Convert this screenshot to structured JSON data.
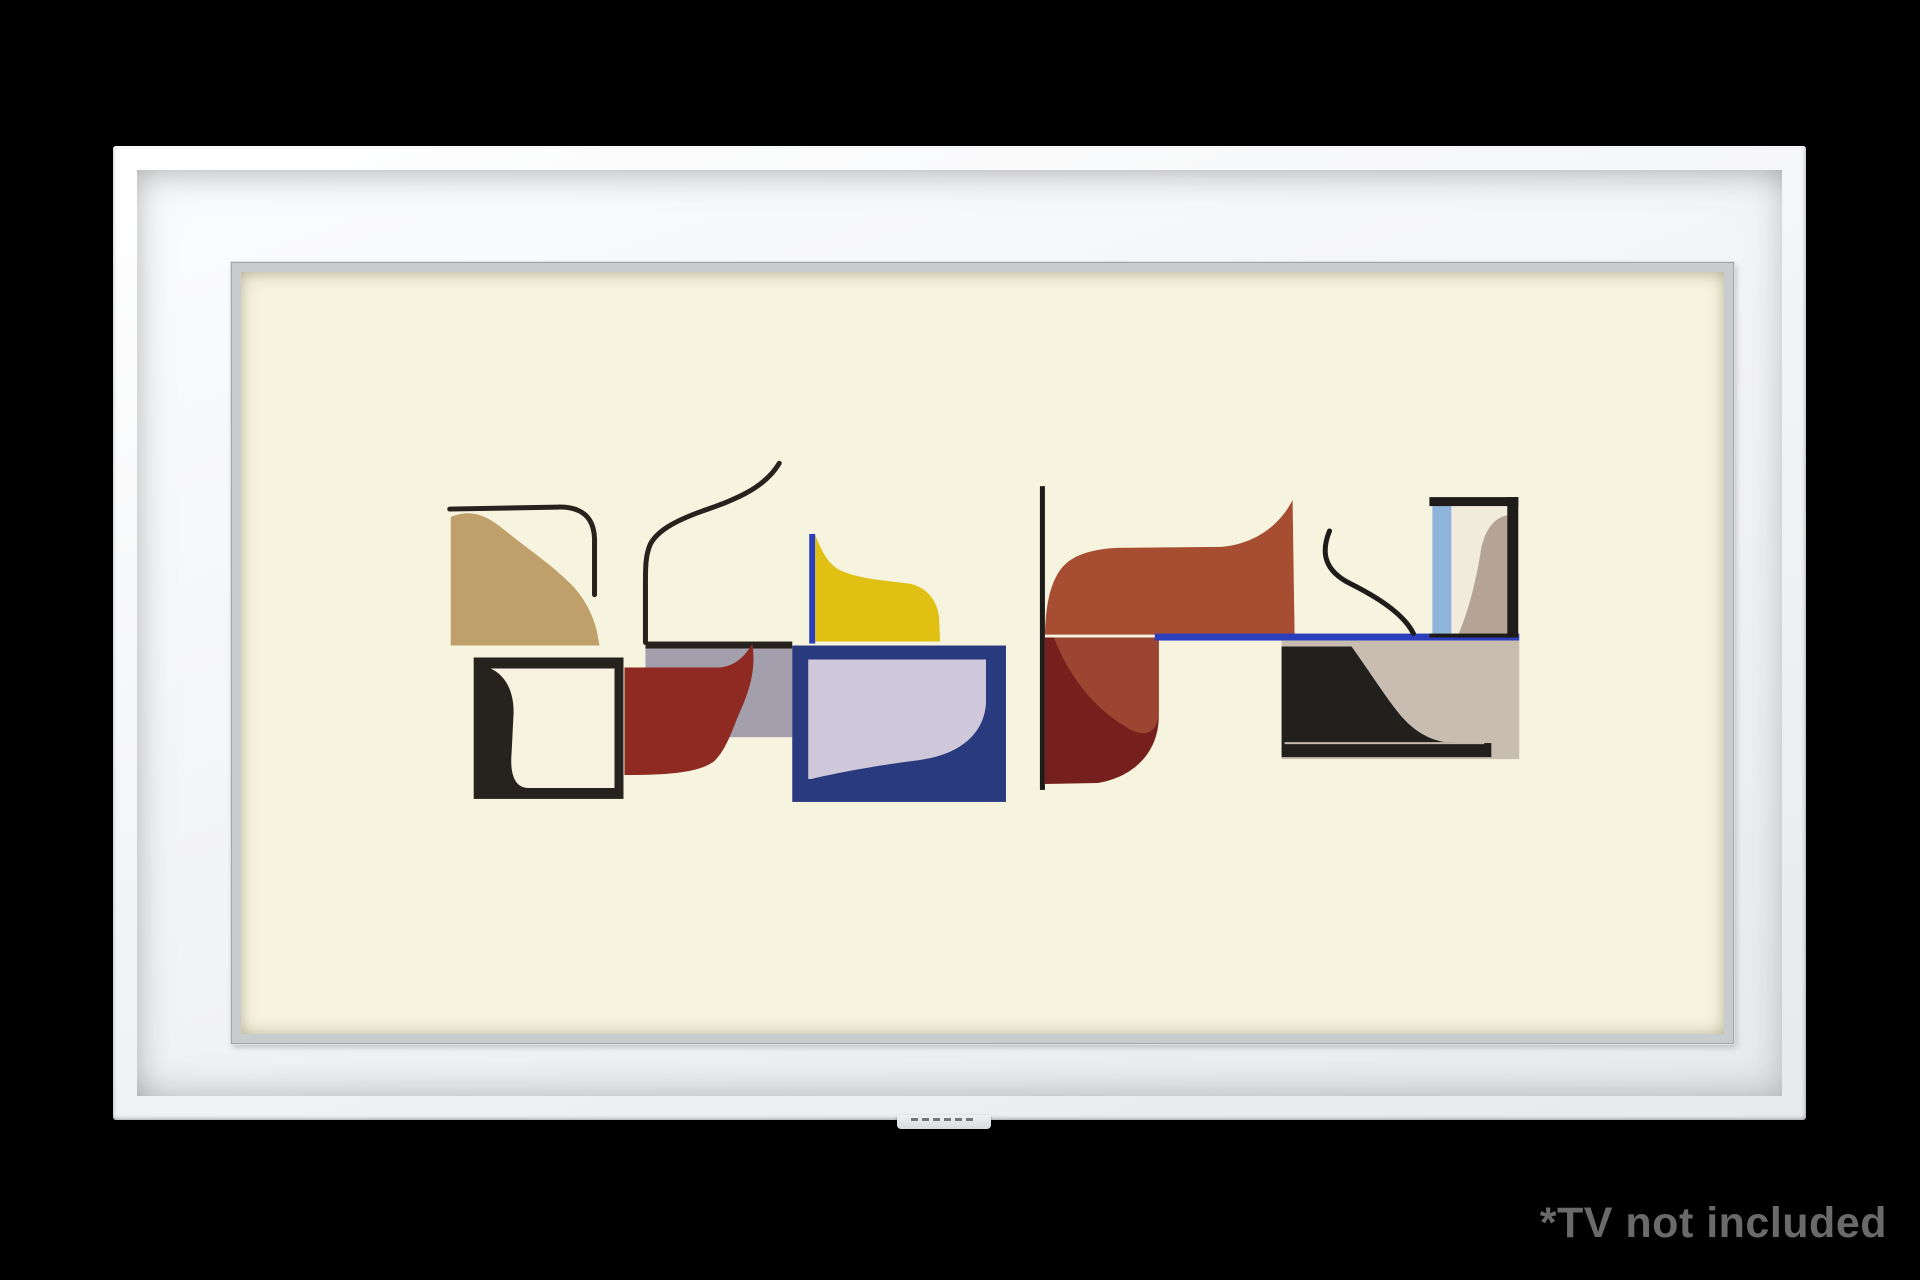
{
  "scene": {
    "background_color": "#000000",
    "description": "Samsung The Frame style white picture frame on black background"
  },
  "disclaimer": {
    "text": "*TV not included",
    "color": "#6a6a6a"
  },
  "frame": {
    "colors": {
      "molding": "#f7f8fa",
      "mat": "#f2f3f5",
      "bevel": "#c9ccce",
      "bottom_tab": "#e4e5e7"
    }
  },
  "artwork": {
    "title": "abstract mid-century composition",
    "canvas_color": "#f6f3de",
    "viewbox": "218 248 1485 765",
    "shapes": [
      {
        "name": "gray-strip",
        "kind": "rect",
        "x": 623,
        "y": 626,
        "w": 147,
        "h": 89,
        "fill": "#a49fad"
      },
      {
        "name": "gray-strip-top-line",
        "kind": "rect",
        "x": 623,
        "y": 619,
        "w": 147,
        "h": 7,
        "fill": "#26231f"
      },
      {
        "name": "red-wave-shape",
        "kind": "path",
        "d": "M602,645 L697,645 C712,644 723,634 730,621 C734,647 727,669 717,691 C709,710 704,727 692,739 C676,751 645,753 602,753 Z",
        "fill": "#8e2a22"
      },
      {
        "name": "tan-wave-square",
        "kind": "path",
        "d": "M428,623 L428,494 C446,486 462,491 478,504 C505,526 528,541 548,561 C562,575 570,592 574,607 L577,623 Z",
        "fill": "#bfa06b"
      },
      {
        "name": "tan-top-corner-line",
        "kind": "path",
        "d": "M427,486 L535,484 Q571,483 572,516 L572,572",
        "stroke": "#26231f",
        "sw": 5
      },
      {
        "name": "left-s-curve-line",
        "kind": "path",
        "d": "M757,440 C741,467 708,478 680,488 C652,498 635,508 628,521 C623,532 623,545 623,560 L623,620",
        "stroke": "#26231f",
        "sw": 5
      },
      {
        "name": "black-frame-square",
        "kind": "rect",
        "x": 451,
        "y": 635,
        "w": 150,
        "h": 142,
        "fill": "#26231f"
      },
      {
        "name": "black-frame-square-hole",
        "kind": "path",
        "d": "M468,646 L592,646 L592,766 L506,766 C492,766 487,752 489,730 L491,690 C491,666 481,652 468,646 Z",
        "fill": "#f6f2e0"
      },
      {
        "name": "navy-rectangle",
        "kind": "rect",
        "x": 770,
        "y": 623,
        "w": 214,
        "h": 157,
        "fill": "#2a3a7e"
      },
      {
        "name": "navy-rectangle-lavender-inner",
        "kind": "path",
        "d": "M786,637 L964,637 L964,681 C962,713 936,733 897,738 C858,743 818,750 789,757 L786,757 Z",
        "fill": "#cfc8da"
      },
      {
        "name": "yellow-left-blue-line",
        "kind": "rect",
        "x": 787,
        "y": 511,
        "w": 6,
        "h": 110,
        "fill": "#2b3fbd"
      },
      {
        "name": "yellow-wave-shape",
        "kind": "path",
        "d": "M793,619 L793,512 C801,532 807,542 819,548 C840,557 868,558 888,561 C906,565 915,579 917,594 L918,619 Z",
        "fill": "#dfc013"
      },
      {
        "name": "center-vertical-line",
        "kind": "rect",
        "x": 1018,
        "y": 463,
        "w": 5,
        "h": 305,
        "fill": "#1d1c1a"
      },
      {
        "name": "maroon-round-shape",
        "kind": "path",
        "d": "M1023,615 L1137,615 L1137,694 C1137,730 1112,755 1076,761 L1023,762 Z",
        "fill": "#76201e"
      },
      {
        "name": "rust-overlay-shape",
        "kind": "path",
        "d": "M1032,615 L1137,615 L1137,688 C1137,708 1126,716 1110,708 C1072,688 1046,652 1032,615 Z",
        "fill": "#9c4631"
      },
      {
        "name": "rust-wave-shape",
        "kind": "path",
        "d": "M1023,612 C1024,577 1030,552 1046,539 C1058,530 1075,526 1095,525 L1200,524 C1232,521 1257,504 1271,477 L1273,612 Z",
        "fill": "#a74d31"
      },
      {
        "name": "blue-horizontal-line",
        "kind": "rect",
        "x": 1133,
        "y": 611,
        "w": 365,
        "h": 7,
        "fill": "#2b3fbd"
      },
      {
        "name": "taupe-panel",
        "kind": "rect",
        "x": 1260,
        "y": 618,
        "w": 238,
        "h": 119,
        "fill": "#c9bdb2"
      },
      {
        "name": "black-sigmoid-wave",
        "kind": "path",
        "d": "M1260,624 L1330,624 C1350,652 1361,670 1375,688 C1389,706 1403,716 1423,720 L1470,721 L1470,735 L1260,735 Z",
        "fill": "#21201c"
      },
      {
        "name": "black-wave-scratch-line",
        "kind": "rect",
        "x": 1263,
        "y": 720,
        "w": 200,
        "h": 2,
        "fill": "#c6bab0"
      },
      {
        "name": "right-frame-interior",
        "kind": "rect",
        "x": 1411,
        "y": 482,
        "w": 76,
        "h": 130,
        "fill": "#f0ebdc"
      },
      {
        "name": "right-frame-blue-stripe",
        "kind": "rect",
        "x": 1411,
        "y": 482,
        "w": 19,
        "h": 130,
        "fill": "#8fb4da"
      },
      {
        "name": "right-frame-taupe-wave",
        "kind": "path",
        "d": "M1437,612 C1448,586 1455,556 1459,531 C1462,511 1470,497 1483,493 L1487,492 L1487,612 Z",
        "fill": "#b5a495"
      },
      {
        "name": "right-frame-top-bar",
        "kind": "rect",
        "x": 1408,
        "y": 474,
        "w": 89,
        "h": 9,
        "fill": "#1d1c1a"
      },
      {
        "name": "right-frame-right-bar",
        "kind": "rect",
        "x": 1486,
        "y": 474,
        "w": 11,
        "h": 141,
        "fill": "#1d1c1a"
      },
      {
        "name": "right-frame-bottom-line",
        "kind": "rect",
        "x": 1408,
        "y": 611,
        "w": 80,
        "h": 4,
        "fill": "#1d1c1a"
      },
      {
        "name": "right-s-curve-line",
        "kind": "path",
        "d": "M1308,508 C1299,530 1303,548 1329,561 C1357,575 1383,592 1392,611",
        "stroke": "#1d1c1a",
        "sw": 5
      }
    ]
  }
}
